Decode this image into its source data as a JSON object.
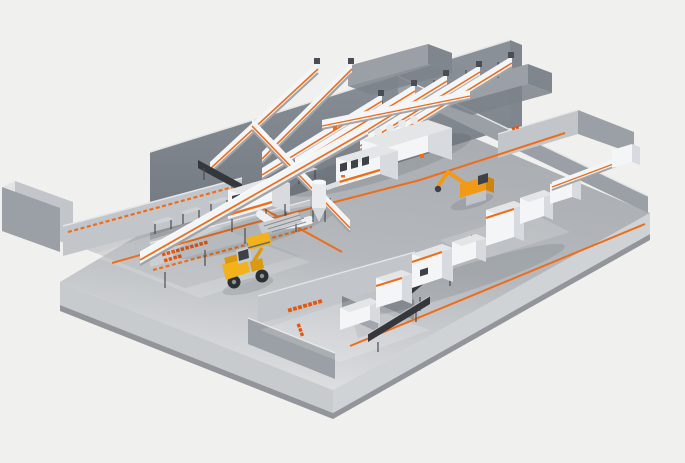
{
  "colors": {
    "background": "#f0f0ee",
    "floor": "#b5b9bd",
    "floor_light": "#dcdee0",
    "floor_dark": "#a7abb0",
    "front_face": "#c8cbce",
    "front_face2": "#d0d3d6",
    "lip": "#92969b",
    "wall_dark": "#80868d",
    "wall_mid": "#9aa0a6",
    "wall_light": "#c2c6ca",
    "edge_light": "#e3e5e7",
    "machine_white": "#f4f5f6",
    "machine_side": "#d7dade",
    "machine_dark": "#4a4e54",
    "belt_dark": "#34373b",
    "accent": "#ee6d1a",
    "accent_text": "#e4570f",
    "loader_yellow": "#f3b11c",
    "excavator_orange": "#f09a18",
    "window_dark": "#3d4248",
    "shadow": "#3c424a"
  },
  "labels": {
    "storage_line_label_1": "■■■■■■■■■■",
    "storage_line_label_2": "■■■■",
    "sorting_area_label": "■■■■■■■",
    "bottom_wall_label": "■■■",
    "wall_marker": "■■"
  }
}
